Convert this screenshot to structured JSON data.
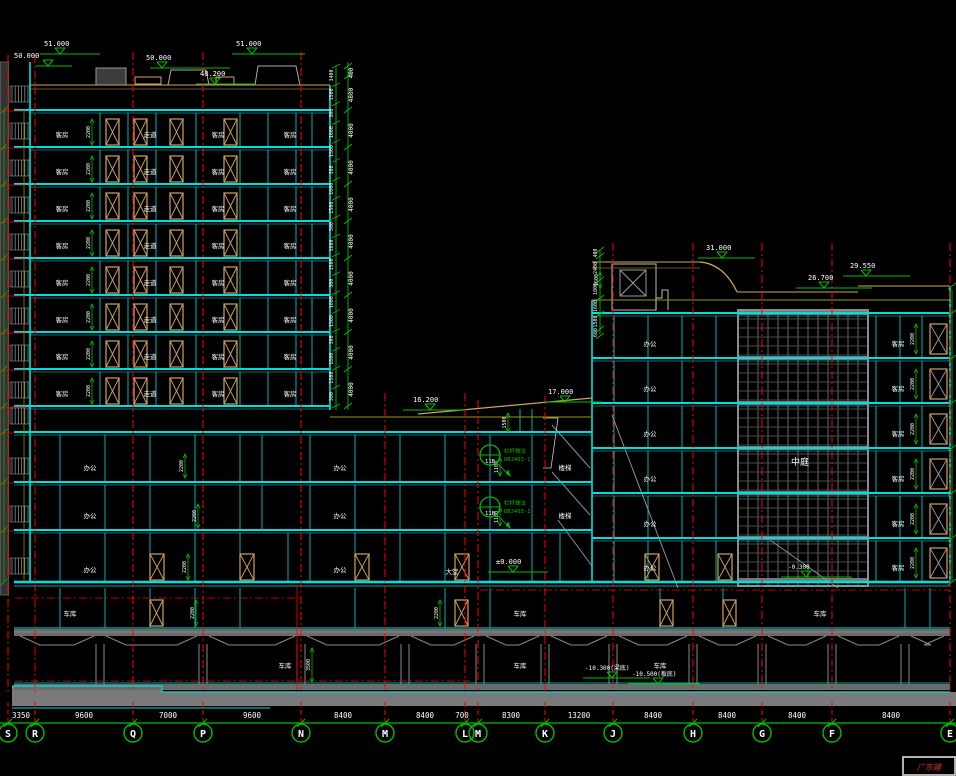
{
  "viewport": {
    "width": 956,
    "height": 776
  },
  "colors": {
    "background": "#000000",
    "structure_cyan": "#00dede",
    "grid_red": "#ff0000",
    "dim_green": "#00bf00",
    "text_white": "#ffffff",
    "door_tan": "#d2a35c",
    "olive": "#9a9a00",
    "yellow": "#b8b800",
    "gray_light": "#aaaaaa",
    "gray_mid": "#787878",
    "gray_dark": "#4a4a4a",
    "title_red": "#8b2020"
  },
  "elevations": {
    "roof_left_a": "50.000",
    "roof_left_b": "51.000",
    "roof_mid_a": "50.000",
    "roof_mid_b": "51.000",
    "roof_step": "48.200",
    "rb_roof_high": "31.000",
    "rb_roof_right": "29.550",
    "rb_roof_low": "26.700",
    "podium_high": "17.000",
    "podium_ramp": "16.200",
    "ground": "±0.000",
    "atrium_base": "-0.300",
    "basement_beam": "-10.300(梁底)",
    "basement_slab": "-10.500(板底)"
  },
  "grid": {
    "bubbles": [
      "S",
      "R",
      "Q",
      "P",
      "N",
      "M",
      "L",
      "M",
      "K",
      "J",
      "H",
      "G",
      "F",
      "E"
    ],
    "spans": [
      "3350",
      "9600",
      "7000",
      "9600",
      "8400",
      "8400",
      "700",
      "8300",
      "13200",
      "8400",
      "8400",
      "8400",
      "8400"
    ]
  },
  "vdims": {
    "tower_outer": [
      "400",
      "4800",
      "4000",
      "4000",
      "4000",
      "4000",
      "4000",
      "4000",
      "4000",
      "4000"
    ],
    "tower_inner": [
      "3400",
      "1500",
      "300",
      "1600",
      "1500",
      "300",
      "1600",
      "1500",
      "300",
      "1600",
      "1500",
      "300",
      "1600",
      "1500",
      "300",
      "1600",
      "1500",
      "300"
    ],
    "rb_left": [
      "400",
      "2400",
      "1800",
      "1600",
      "1500",
      "600"
    ]
  },
  "annotations": {
    "detail_id": "11B",
    "detail_note": "栏杆做法",
    "detail_code": "DBJ403-1",
    "dim_2200": "2200",
    "dim_1500": "1500",
    "dim_1100": "1100",
    "dim_3500": "3500",
    "dim_1600": "1600"
  },
  "labels": {
    "guest_room": "客房",
    "corridor": "走道",
    "office": "办公",
    "parking": "车库",
    "atrium": "中庭",
    "stair": "楼梯",
    "lobby": "大堂"
  },
  "title_block": {
    "text": "广东建"
  }
}
